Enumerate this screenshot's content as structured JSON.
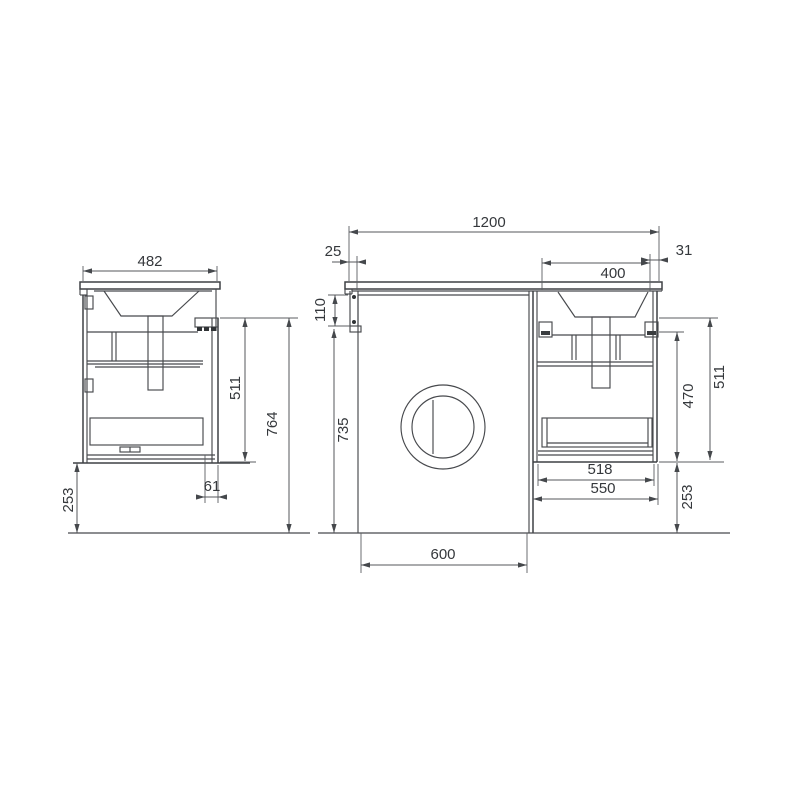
{
  "page": {
    "background_color": "#ffffff"
  },
  "drawing": {
    "kind": "technical dimension drawing",
    "subject": "wall-hung vanity unit with basin over washing-machine niche, side view and front view",
    "unit": "mm",
    "colors": {
      "line": "#47494d",
      "dimension": "#54575b",
      "text": "#35383c",
      "background": "#ffffff"
    },
    "views": {
      "side": {
        "name": "side view",
        "dims": {
          "depth": "482",
          "carcass_height": "511",
          "overall_height": "764",
          "clearance_below": "253",
          "bottom_offset": "61"
        }
      },
      "front": {
        "name": "front view",
        "dims": {
          "overall_width": "1200",
          "left_offset": "25",
          "basin_width": "400",
          "right_offset": "31",
          "apron_height": "110",
          "niche_height": "735",
          "niche_width": "600",
          "cabinet_inner_width": "518",
          "cabinet_width": "550",
          "cabinet_body_height": "470",
          "carcass_height": "511",
          "clearance_below": "253"
        }
      }
    }
  }
}
